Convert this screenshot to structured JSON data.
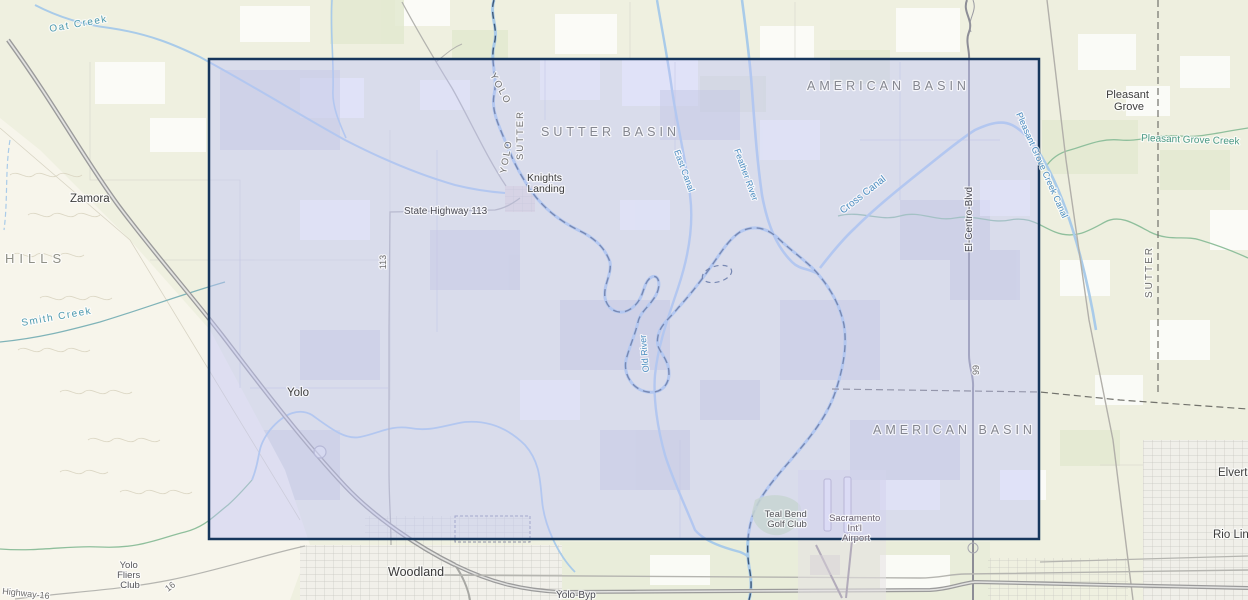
{
  "app": {
    "type": "web-map-viewport"
  },
  "labels": {
    "oat_creek": "Oat Creek",
    "zamora": "Zamora",
    "hills": "HILLS",
    "smith_creek": "Smith Creek",
    "yolo_town": "Yolo",
    "yolo_fliers_1": "Yolo",
    "yolo_fliers_2": "Fliers",
    "yolo_fliers_3": "Club",
    "highway_16": "Highway-16",
    "route_16": "16",
    "woodland": "Woodland",
    "yolo_byp": "Yolo-Byp",
    "knights_landing_1": "Knights",
    "knights_landing_2": "Landing",
    "state_highway_113": "State Highway 113",
    "route_113": "113",
    "yolo_county_a": "YOLO",
    "yolo_county_b": "YOLO",
    "sutter_county_a": "SUTTER",
    "sutter_county_right": "SUTTER",
    "sutter_basin": "SUTTER BASIN",
    "american_basin_north": "AMERICAN BASIN",
    "american_basin_south": "AMERICAN BASIN",
    "east_canal": "East Canal",
    "feather_river": "Feather River",
    "cross_canal": "Cross Canal",
    "old_river": "Old River",
    "pg_creek_canal": "Pleasant Grove Creek Canal",
    "el_centro_blvd": "El-Centro-Blvd",
    "route_99": "99",
    "pleasant_grove_1": "Pleasant",
    "pleasant_grove_2": "Grove",
    "pleasant_grove_creek": "Pleasant Grove Creek",
    "teal_bend_1": "Teal Bend",
    "teal_bend_2": "Golf Club",
    "airport_1": "Sacramento",
    "airport_2": "Int'l",
    "airport_3": "Airport",
    "elverta": "Elverta",
    "rio_linda": "Rio Linda"
  },
  "colors": {
    "selection_border": "#16365c",
    "selection_fill": "rgba(190,196,248,0.45)",
    "water_line": "#a9cbe9",
    "water_label": "#4d8ec0",
    "creek_label": "#4c9a86",
    "basin_label": "#84868f",
    "land": "#eff0e0"
  }
}
